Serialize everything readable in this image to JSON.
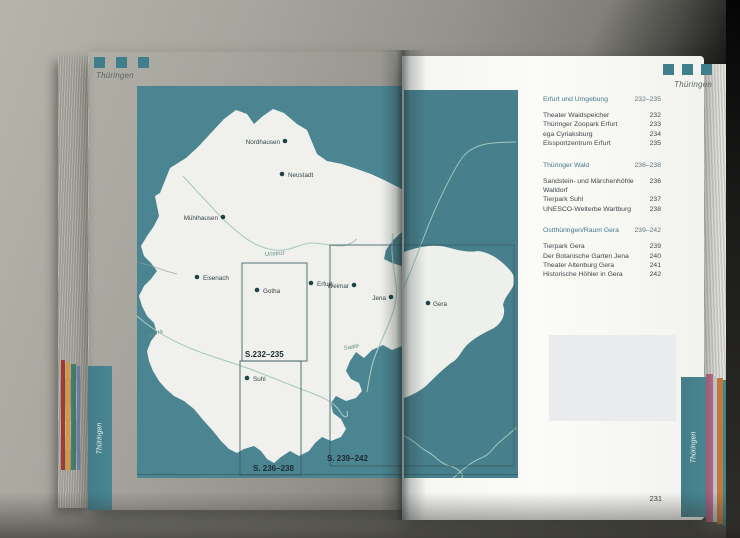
{
  "left_page": {
    "section_label": "Thüringen",
    "page_number": "230",
    "tab_label": "Thüringen"
  },
  "right_page": {
    "section_label": "Thüringen",
    "page_number": "231",
    "tab_label": "Thüringen",
    "index": {
      "sections": [
        {
          "title": "Erfurt und Umgebung",
          "pages": "232–235",
          "items": [
            {
              "label": "Theater Waidspeicher",
              "page": "232"
            },
            {
              "label": "Thüringer Zoopark Erfurt",
              "page": "233"
            },
            {
              "label": "ega Cyriaksburg",
              "page": "234"
            },
            {
              "label": "Eissportzentrum Erfurt",
              "page": "235"
            }
          ]
        },
        {
          "title": "Thüringer Wald",
          "pages": "236–238",
          "items": [
            {
              "label": "Sandstein- und Märchenhöhle Walldorf",
              "page": "236"
            },
            {
              "label": "Tierpark Suhl",
              "page": "237"
            },
            {
              "label": "UNESCO-Welterbe Wartburg",
              "page": "238"
            }
          ]
        },
        {
          "title": "Ostthüringen/Raum Gera",
          "pages": "239–242",
          "items": [
            {
              "label": "Tierpark Gera",
              "page": "239"
            },
            {
              "label": "Der Botanische Garten Jena",
              "page": "240"
            },
            {
              "label": "Theater Altenburg Gera",
              "page": "241"
            },
            {
              "label": "Historische Höhler in Gera",
              "page": "242"
            }
          ]
        }
      ]
    }
  },
  "map": {
    "cities": [
      {
        "name": "Nordhausen"
      },
      {
        "name": "Neustadt"
      },
      {
        "name": "Mühlhausen"
      },
      {
        "name": "Eisenach"
      },
      {
        "name": "Gotha"
      },
      {
        "name": "Erfurt"
      },
      {
        "name": "Weimar"
      },
      {
        "name": "Jena"
      },
      {
        "name": "Gera"
      },
      {
        "name": "Suhl"
      }
    ],
    "rivers": [
      {
        "name": "Unstrut"
      },
      {
        "name": "Werra"
      },
      {
        "name": "Saale"
      }
    ],
    "inset_labels": [
      {
        "label": "S.232–235"
      },
      {
        "label": "S. 236–238"
      },
      {
        "label": "S. 239–242"
      }
    ]
  },
  "colors": {
    "map_teal": "#4b8591",
    "accent_teal": "#3e7f8b",
    "heading_teal": "#40798c"
  }
}
